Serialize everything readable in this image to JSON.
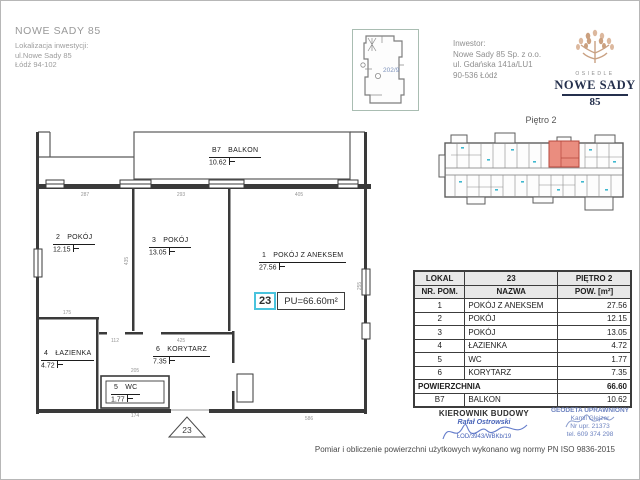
{
  "header": {
    "title": "NOWE SADY 85",
    "loc_label": "Lokalizacja inwestycji:",
    "loc_line1": "ul.Nowe Sady 85",
    "loc_line2": "Łódź 94-102"
  },
  "investor": {
    "label": "Inwestor:",
    "line1": "Nowe Sady 85 Sp. z o.o.",
    "line2": "ul. Gdańska 141a/LU1",
    "line3": "90-536 Łódź"
  },
  "logo": {
    "estate": "OSIEDLE",
    "name": "NOWE SADY",
    "number": "85"
  },
  "site_plan": {
    "parcel": "202/9"
  },
  "floor_overview": {
    "title": "Piętro 2"
  },
  "plan": {
    "unit_badge": "23",
    "pu_text": "PU=66.60m²",
    "entrance_marker": "23",
    "rooms": [
      {
        "num": "1",
        "name": "POKÓJ Z ANEKSEM",
        "area": "27.56"
      },
      {
        "num": "2",
        "name": "POKÓJ",
        "area": "12.15"
      },
      {
        "num": "3",
        "name": "POKÓJ",
        "area": "13.05"
      },
      {
        "num": "4",
        "name": "ŁAZIENKA",
        "area": "4.72"
      },
      {
        "num": "5",
        "name": "WC",
        "area": "1.77"
      },
      {
        "num": "6",
        "name": "KORYTARZ",
        "area": "7.35"
      },
      {
        "num": "B7",
        "name": "BALKON",
        "area": "10.62"
      }
    ],
    "dims": [
      "287",
      "293",
      "405",
      "435",
      "175",
      "112",
      "425",
      "205",
      "174",
      "586",
      "255"
    ]
  },
  "table": {
    "lokal_label": "LOKAL",
    "lokal_value": "23",
    "floor_label": "PIĘTRO 2",
    "nr_label": "NR. POM.",
    "name_label": "NAZWA",
    "pow_label": "POW. [m²]",
    "total_label": "POWIERZCHNIA",
    "total_value": "66.60"
  },
  "signatures": {
    "left_title": "KIEROWNIK BUDOWY",
    "left_name": "Rafał Ostrowski",
    "left_no": "ŁOD/3943/WBKb/19",
    "right_title": "GEODETA UPRAWNIONY",
    "right_name": "Kamil Glejzer",
    "right_no": "Nr upr. 21373",
    "right_tel": "tel. 609 374 298"
  },
  "footer": {
    "note": "Pomiar i obliczenie powierzchni użytkowych wykonano wg normy PN ISO 9836-2015"
  },
  "colors": {
    "highlight_unit": "#ea8d7f",
    "badge_border": "#49c3dd",
    "signature_blue": "#4763b8",
    "logo_navy": "#25304d",
    "leaf_beige": "#dcb89e"
  }
}
